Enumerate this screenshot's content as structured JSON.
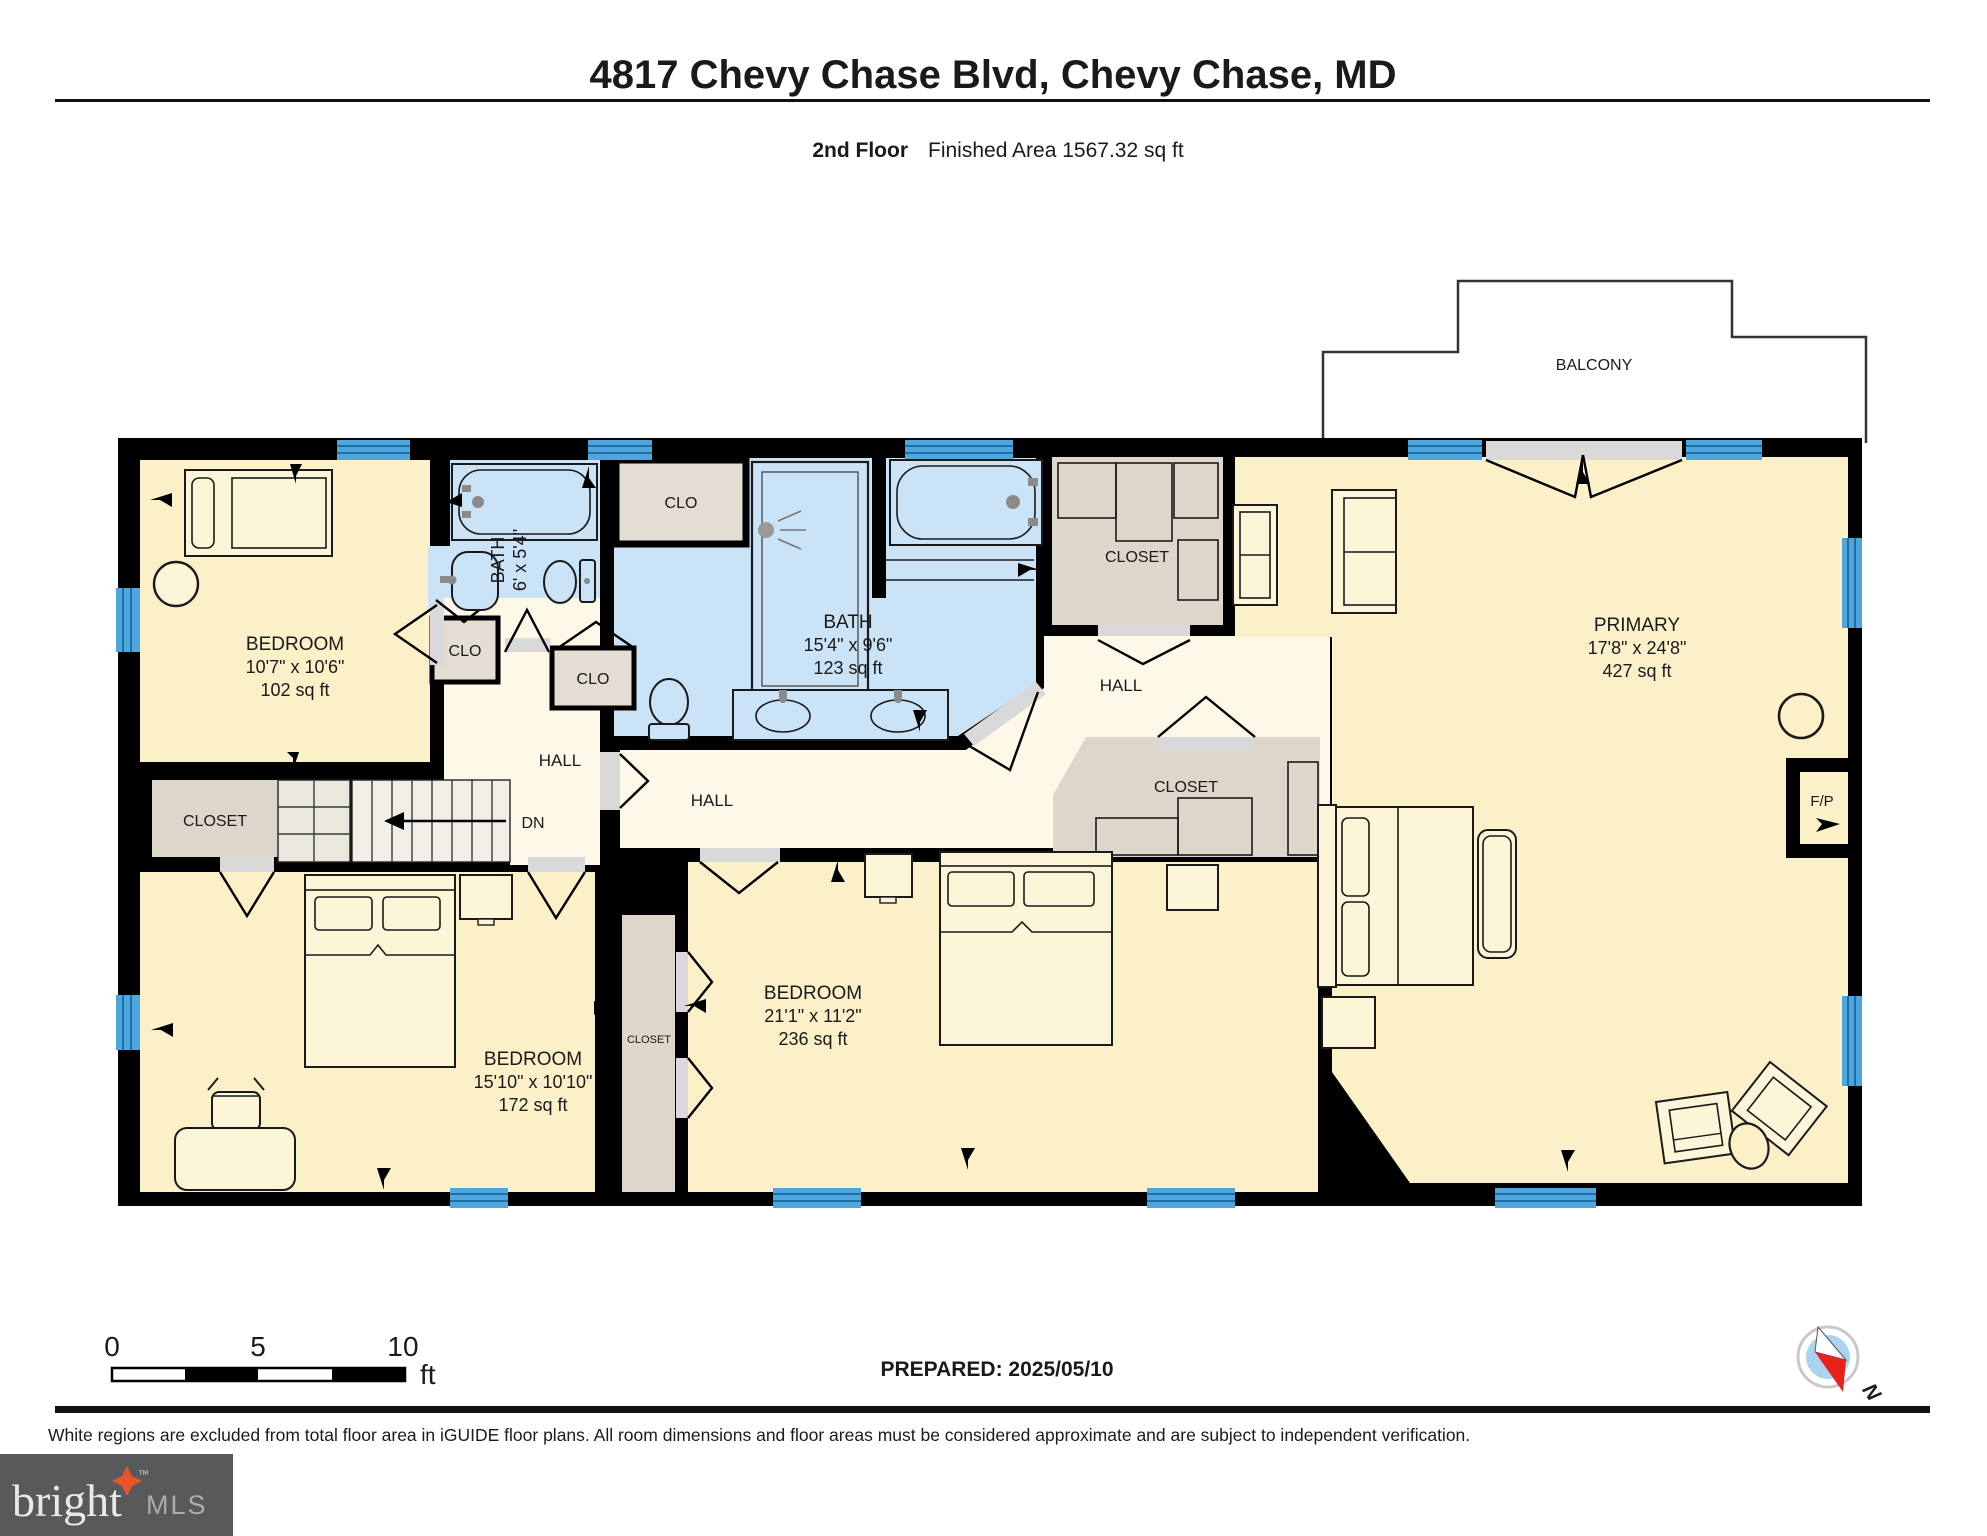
{
  "header": {
    "title": "4817 Chevy Chase Blvd, Chevy Chase, MD",
    "floor_label": "2nd Floor",
    "area_label": "Finished Area 1567.32 sq ft"
  },
  "plan": {
    "balcony": "BALCONY",
    "rooms": {
      "bedroom_tl": {
        "name": "BEDROOM",
        "dims": "10'7\" x 10'6\"",
        "area": "102 sq ft"
      },
      "bath_small": {
        "name": "BATH",
        "dims": "6' x 5'4\""
      },
      "bath_main": {
        "name": "BATH",
        "dims": "15'4\" x 9'6\"",
        "area": "123 sq ft"
      },
      "bedroom_bl": {
        "name": "BEDROOM",
        "dims": "15'10\" x 10'10\"",
        "area": "172 sq ft"
      },
      "bedroom_mid": {
        "name": "BEDROOM",
        "dims": "21'1\" x 11'2\"",
        "area": "236 sq ft"
      },
      "primary": {
        "name": "PRIMARY",
        "dims": "17'8\" x 24'8\"",
        "area": "427 sq ft"
      }
    },
    "labels": {
      "clo": "CLO",
      "closet": "CLOSET",
      "hall": "HALL",
      "dn": "DN",
      "fireplace": "F/P"
    }
  },
  "footer": {
    "scale": {
      "t0": "0",
      "t5": "5",
      "t10": "10",
      "unit": "ft"
    },
    "prepared": "PREPARED: 2025/05/10",
    "compass_n": "N",
    "disclaimer": "White regions are excluded from total floor area in iGUIDE floor plans. All room dimensions and floor areas must be considered approximate and are subject to independent verification."
  },
  "logo": {
    "brand": "bright",
    "tm": "™",
    "suffix": "MLS"
  },
  "colors": {
    "wall": "#000000",
    "room_cream": "#fcf0c8",
    "hall_cream": "#fdf8e8",
    "bath_blue": "#cbe3f6",
    "closet_beige": "#ded6cb",
    "window_blue": "#4ea6dc",
    "door_grey": "#d9d9d9",
    "logo_bg": "#58595b",
    "logo_star": "#e8532c"
  }
}
